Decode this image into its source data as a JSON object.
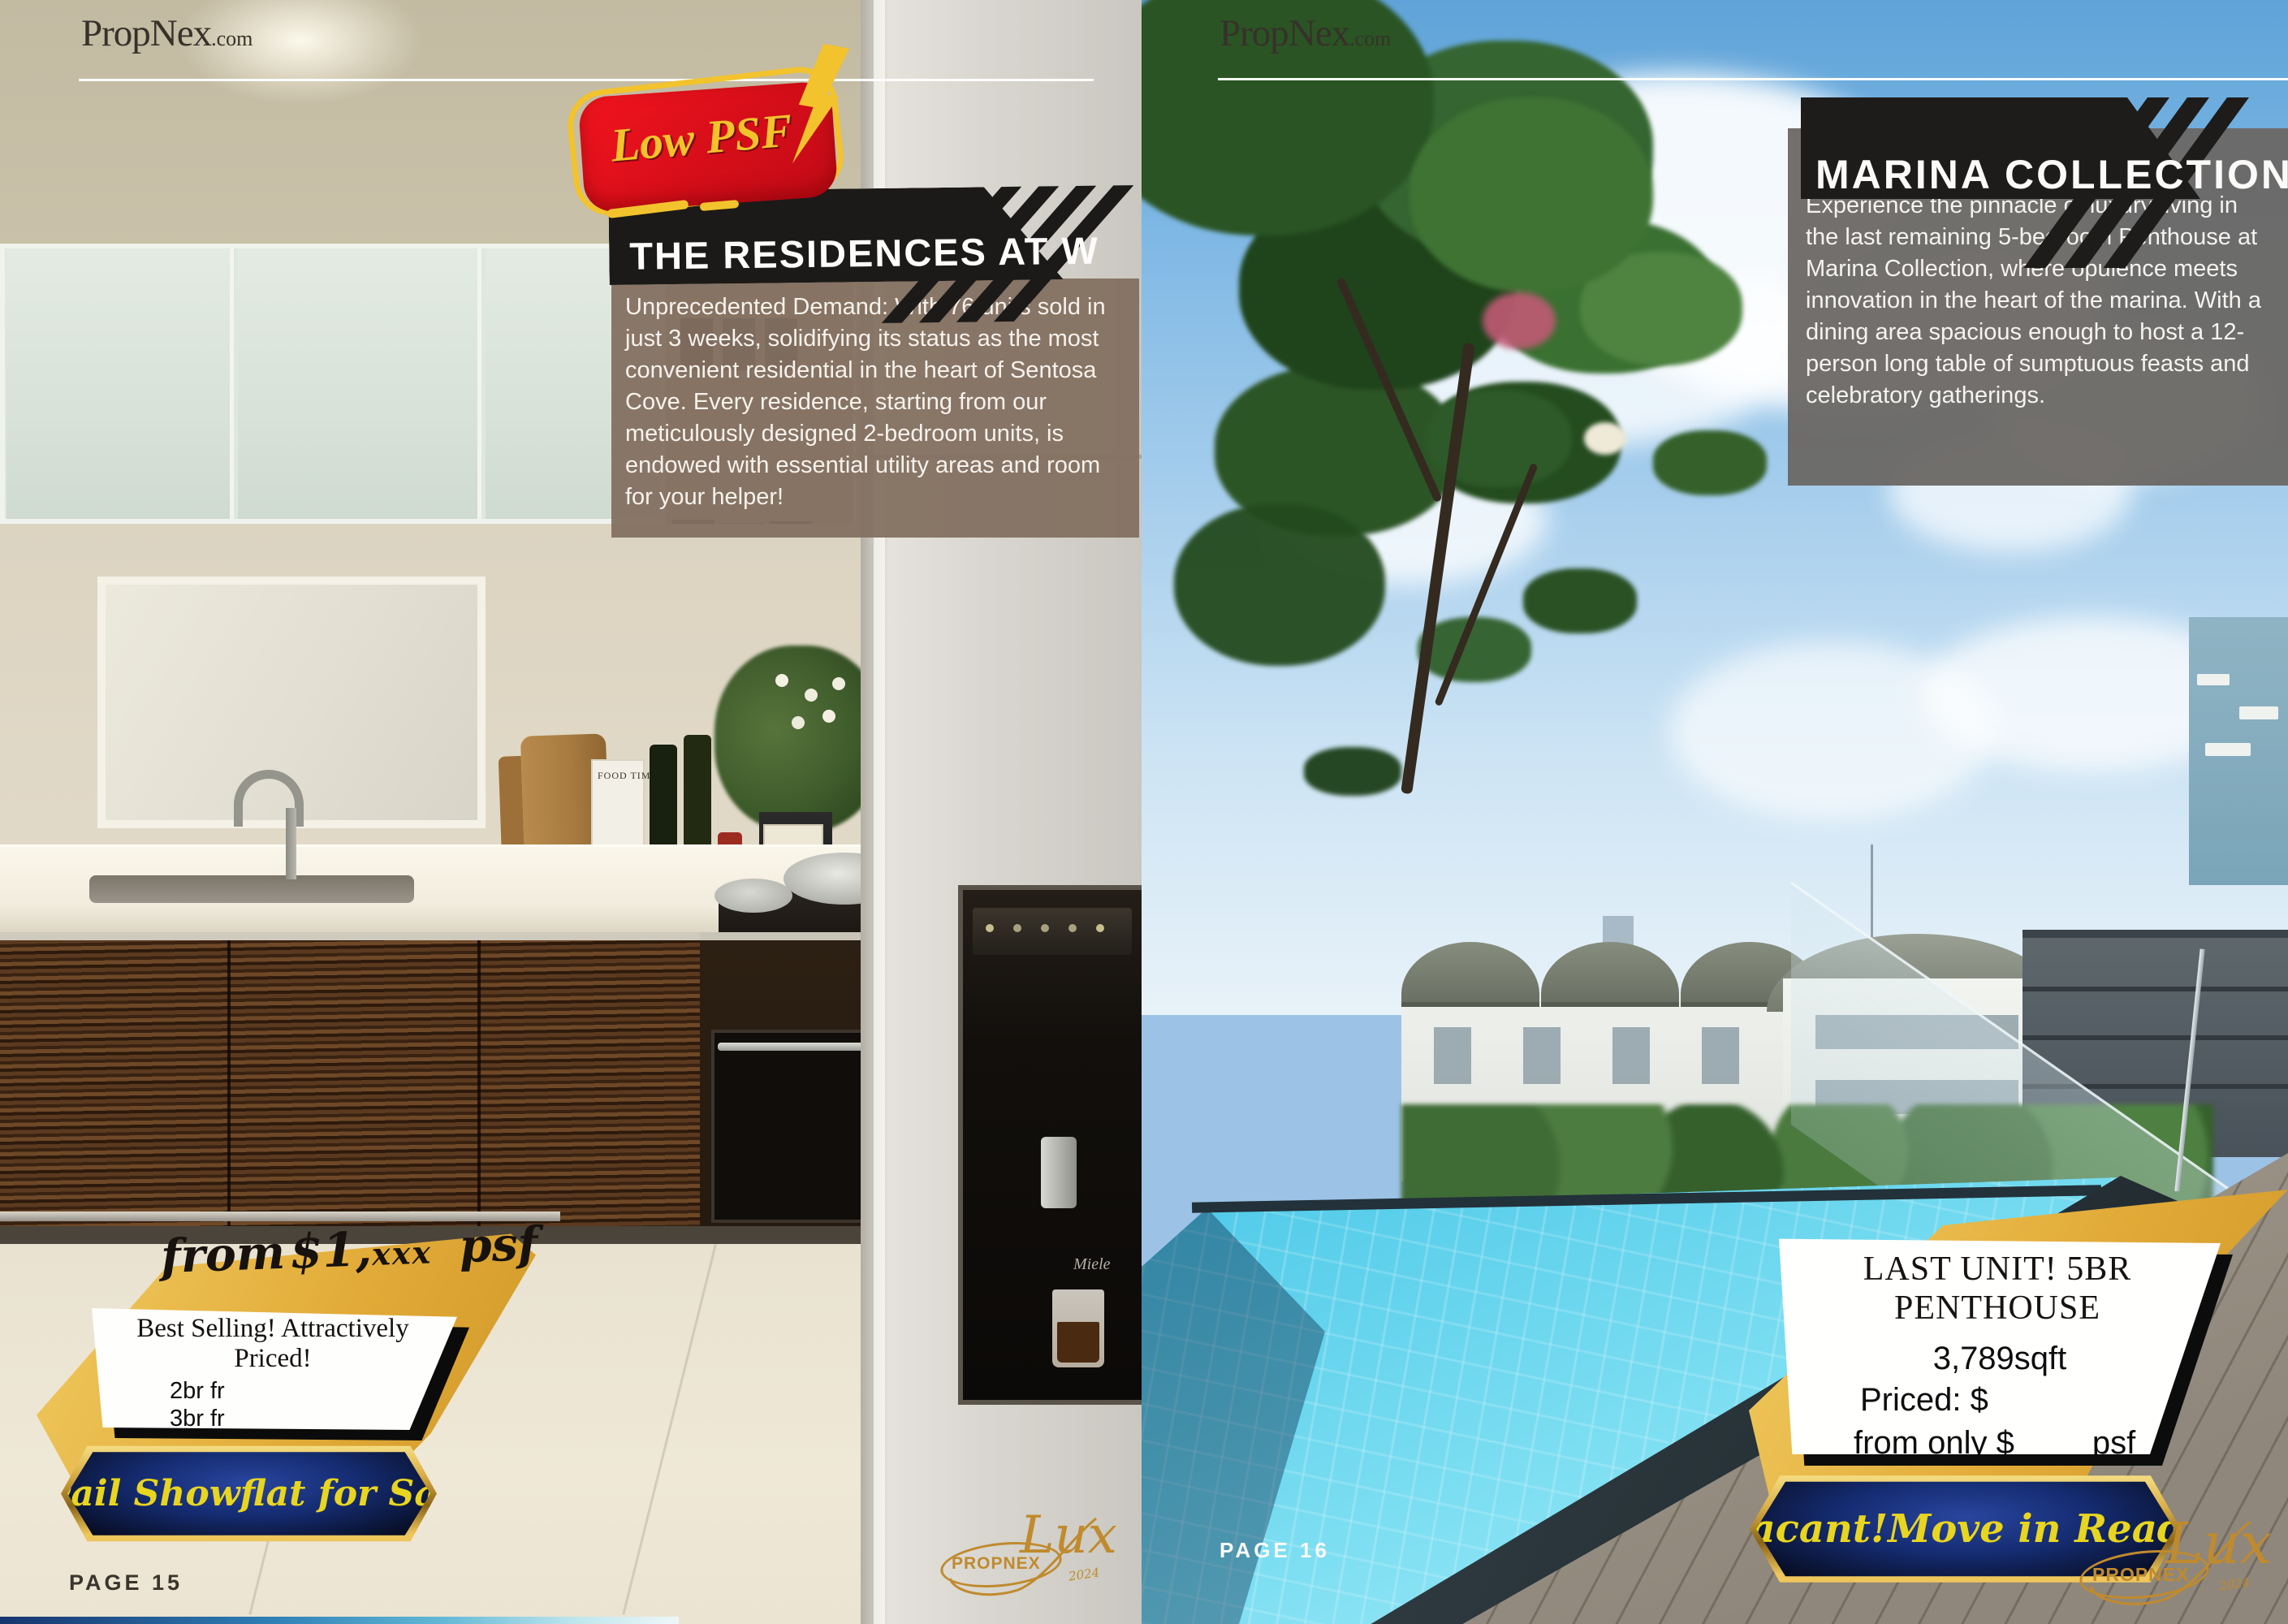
{
  "brand": {
    "name": "PropNex",
    "tld": ".com"
  },
  "left_page": {
    "badge_label": "Low PSF",
    "title": "THE RESIDENCES AT W",
    "description": "Unprecedented Demand: With 76 units sold in just 3 weeks, solidifying its status as the most convenient residential in the heart of Sentosa Cove. Every residence, starting from our meticulously designed 2-bedroom units, is endowed with essential utility areas and room for your helper!",
    "price_from": "from",
    "price_amount": "$1,",
    "price_xxx": "xxx",
    "price_unit": "psf",
    "offer": {
      "headline": "Best Selling! Attractively Priced!",
      "items": [
        "2br fr",
        "3br fr",
        "4br fr",
        "PH fr"
      ]
    },
    "ribbon": "Avail Showflat for Sale",
    "page_label": "PAGE 15",
    "magazine_label": "FOOD TIME",
    "appliance_brand": "Miele"
  },
  "right_page": {
    "title": "MARINA COLLECTION",
    "description": "Experience the pinnacle of luxury living in the last remaining 5-bedroom Penthouse at Marina Collection, where opulence meets innovation in the heart of the marina. With a dining area spacious enough to host a 12-person long table of sumptuous feasts and celebratory gatherings.",
    "offer": {
      "headline": "LAST UNIT! 5BR PENTHOUSE",
      "size": "3,789sqft",
      "priced_label": "Priced: $",
      "from_label": "from only $",
      "unit_label": "psf"
    },
    "ribbon": "Vacant!Move in Ready",
    "page_label": "PAGE 16"
  },
  "lux_logo": {
    "brand": "PROPNEX",
    "script": "Lux",
    "year": "2024"
  },
  "colors": {
    "badge_red": "#d50e19",
    "badge_yellow": "#f2c32c",
    "banner_black": "#1b1a18",
    "left_overlay_brown": "#837061",
    "right_overlay_gray": "#6a6764",
    "accent_gold": "#e2ab38",
    "ribbon_yellow": "#e8d51f",
    "ribbon_navy": "#152c72"
  }
}
